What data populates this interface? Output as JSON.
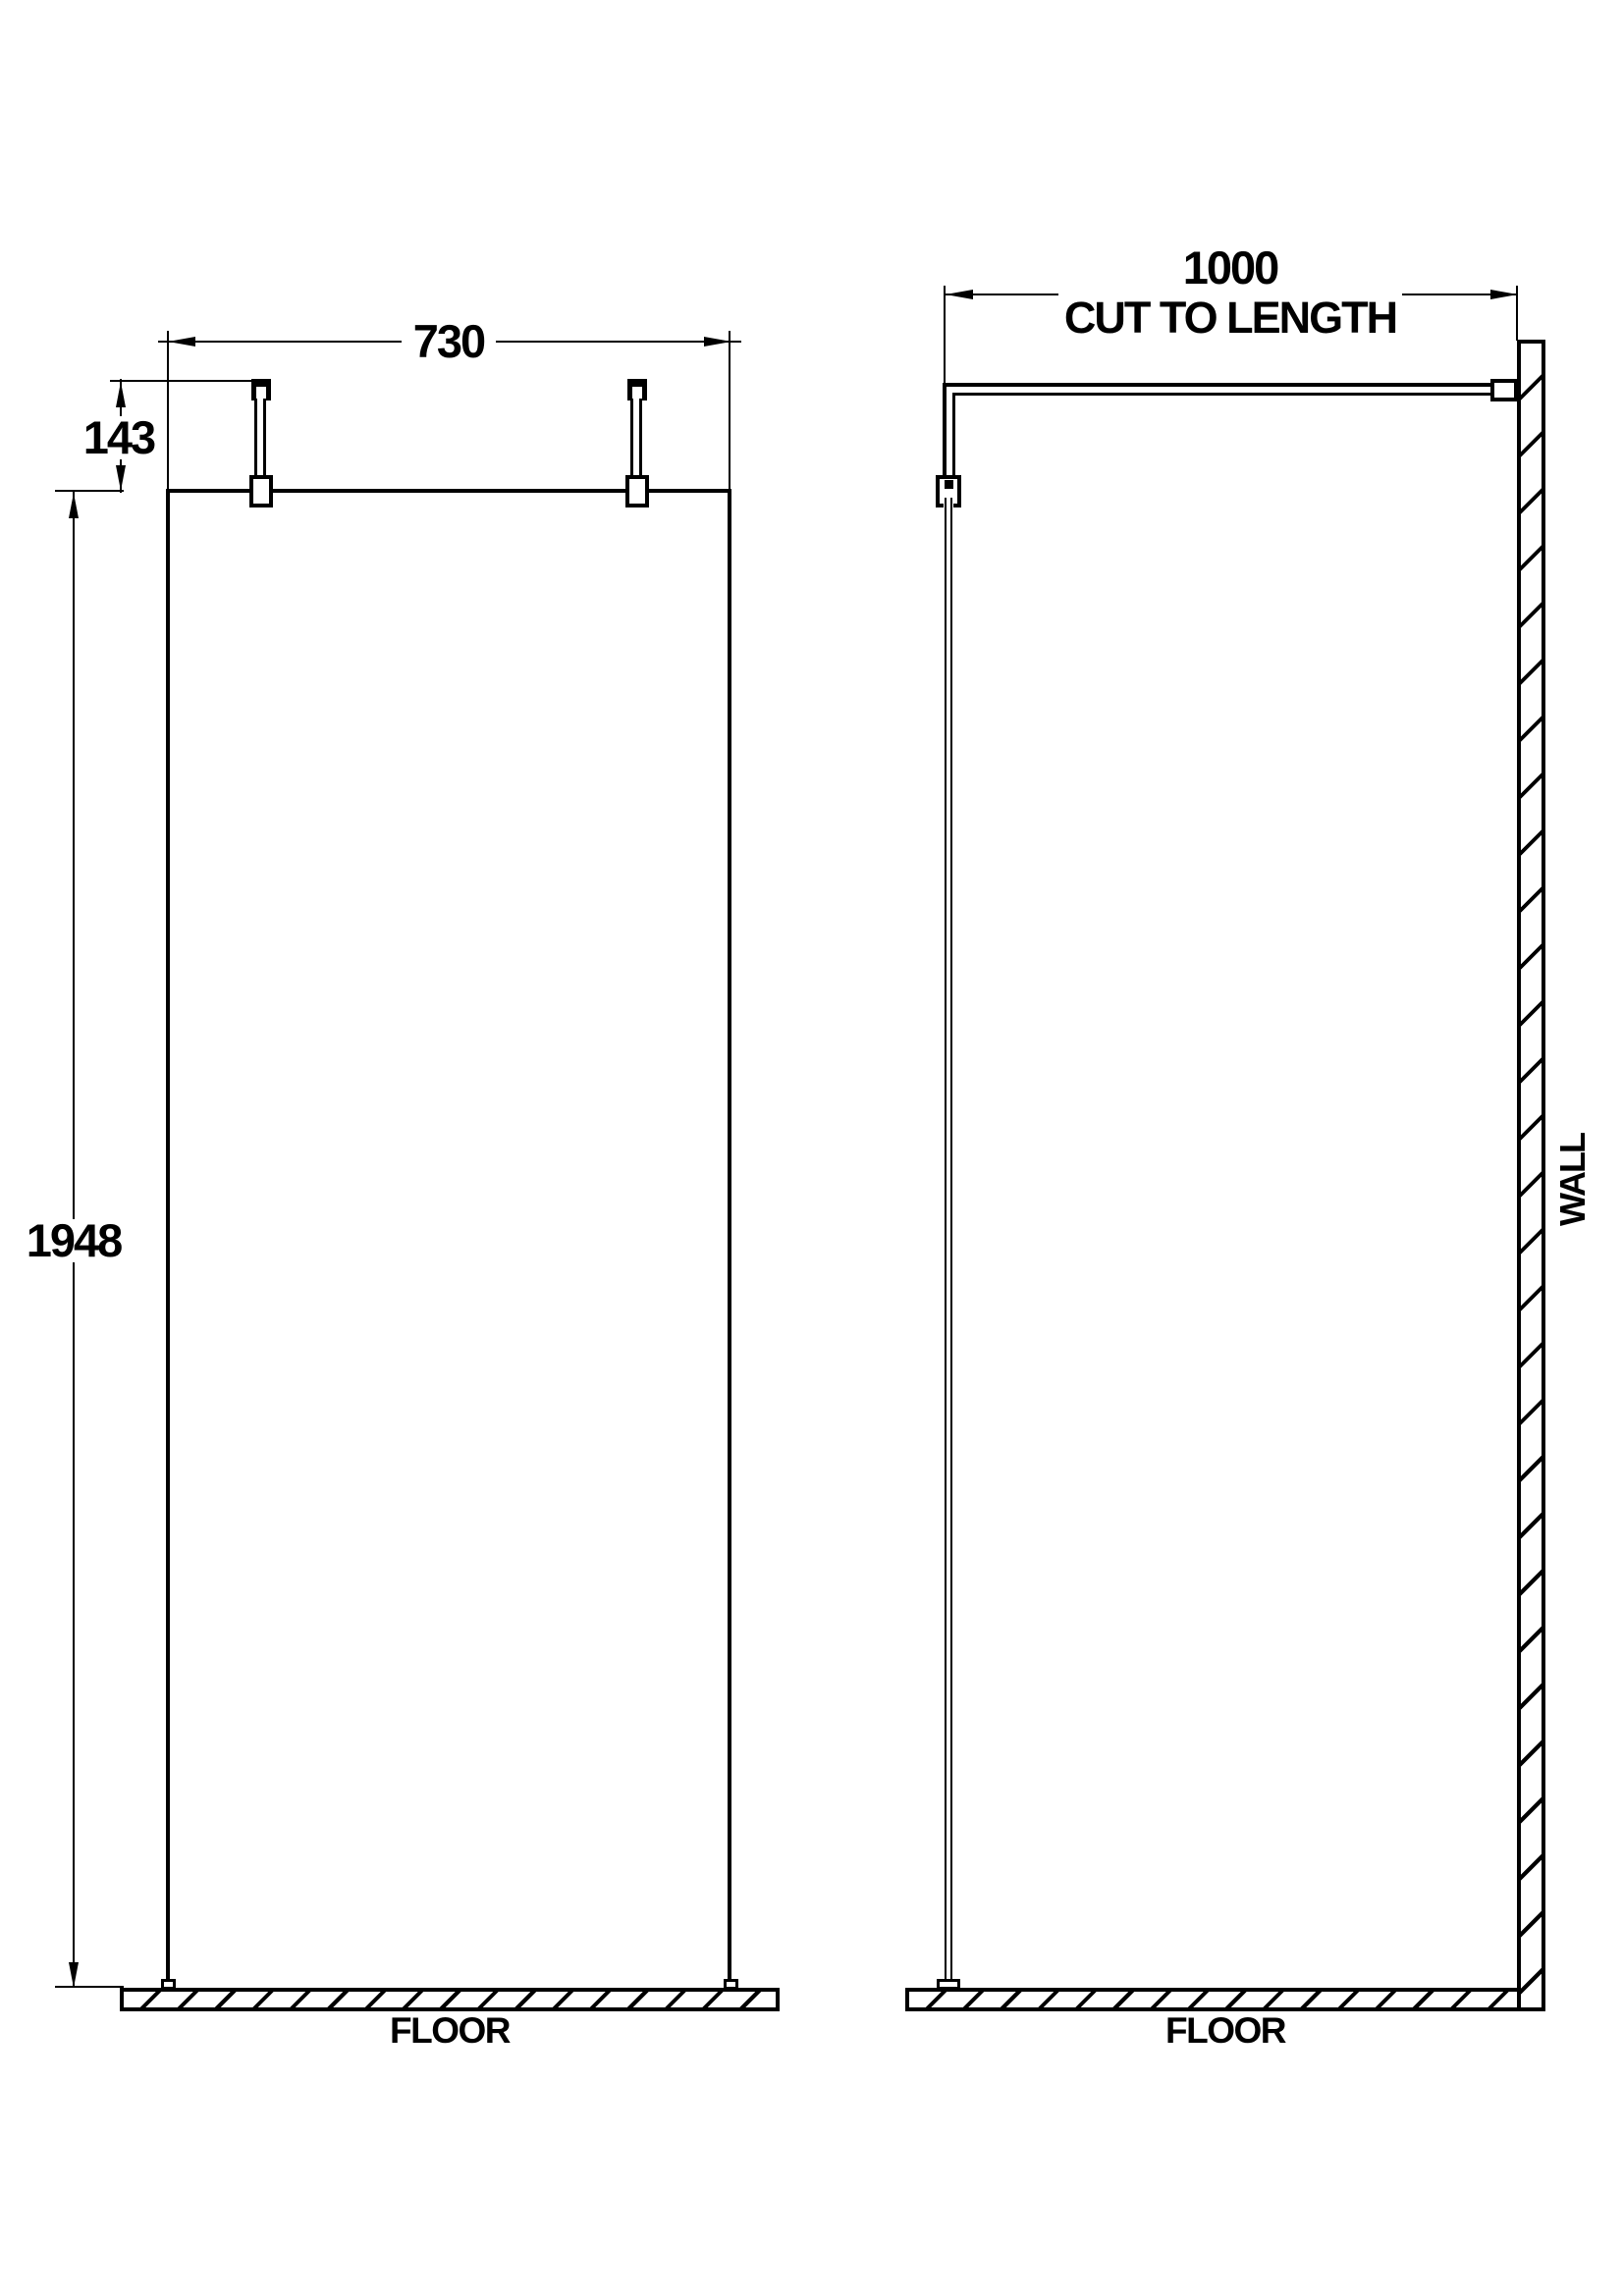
{
  "drawing": {
    "front_view": {
      "dim_width": "730",
      "dim_bracket_height": "143",
      "dim_height": "1948",
      "floor_label": "FLOOR"
    },
    "side_view": {
      "dim_depth": "1000",
      "dim_depth_note": "CUT TO LENGTH",
      "wall_label": "WALL",
      "floor_label": "FLOOR"
    },
    "colors": {
      "line": "#000000",
      "background": "#ffffff"
    }
  }
}
